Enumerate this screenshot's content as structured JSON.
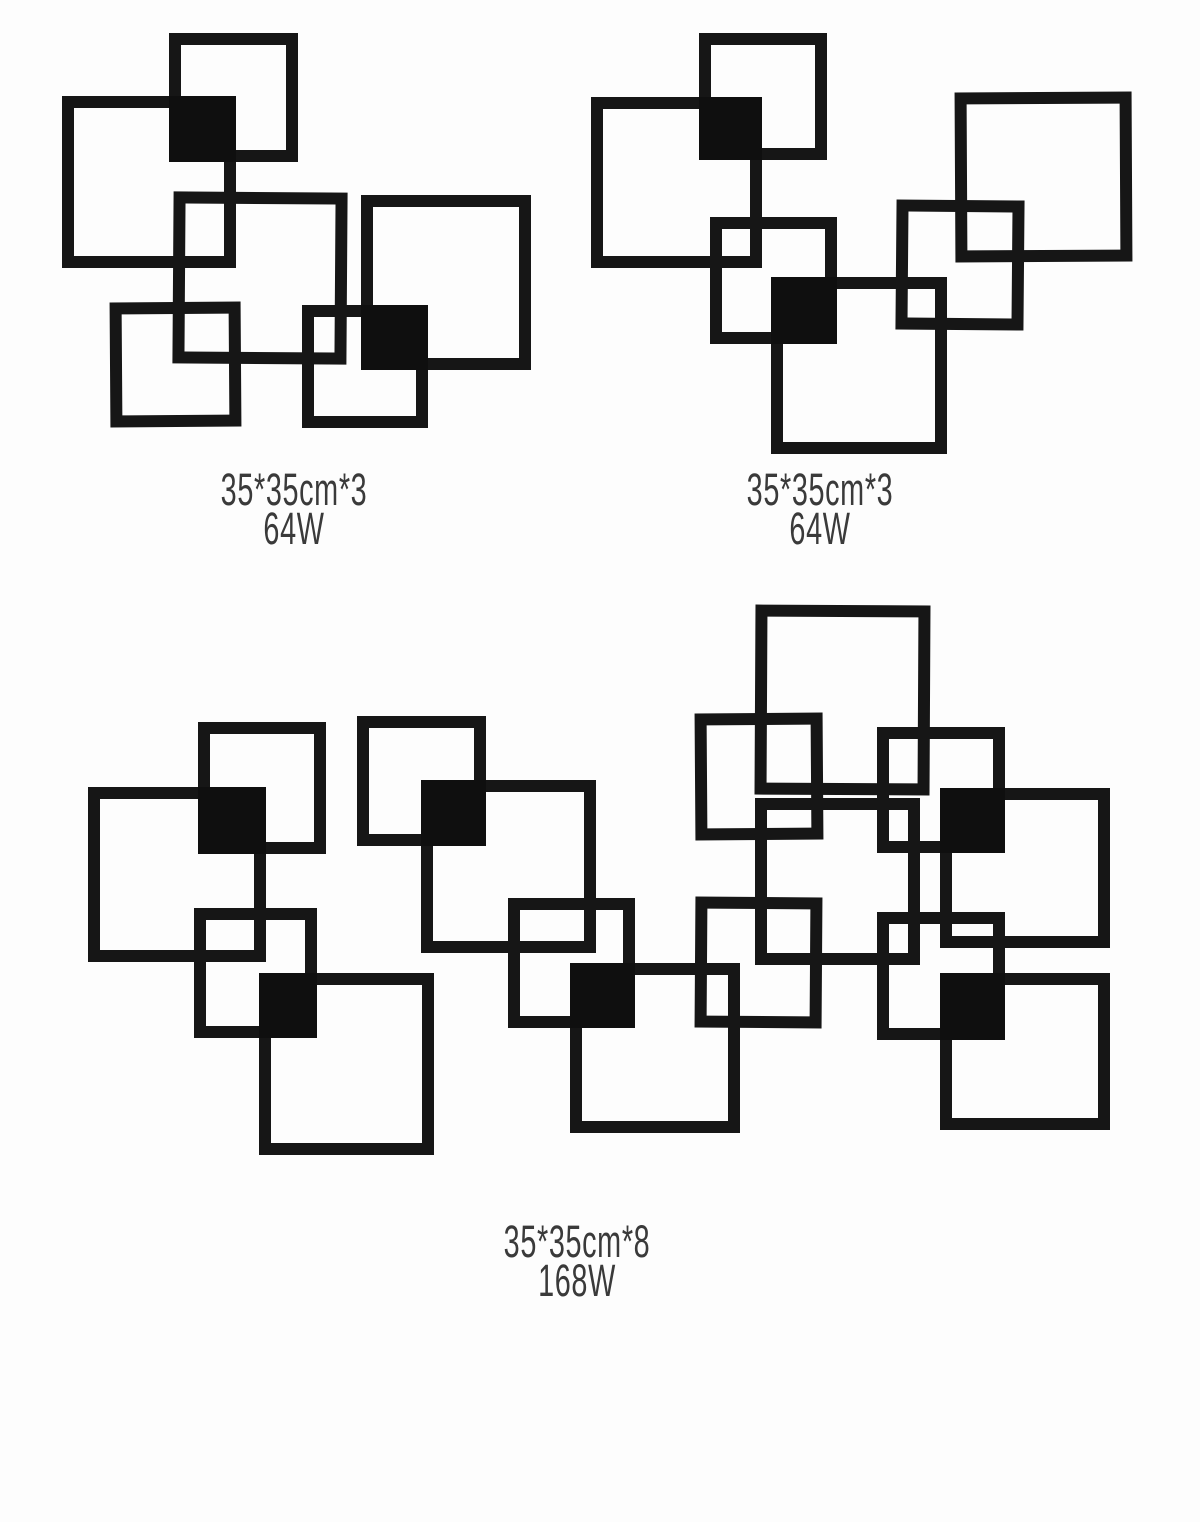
{
  "meta": {
    "canvas_width": 1200,
    "canvas_height": 1522,
    "background": "#fdfdfd"
  },
  "colors": {
    "frame": "#161616",
    "module": "#0f0f0f",
    "label_text": "#3a3a3a"
  },
  "stroke_width": 12,
  "arrangements": [
    {
      "name": "three-panel-left",
      "label": {
        "line1": "35*35cm*3",
        "line2": "64W",
        "cx": 294,
        "top": 470
      },
      "frames": [
        [
          169,
          33,
          129,
          129,
          0
        ],
        [
          62,
          96,
          174,
          172,
          0
        ],
        [
          173,
          192,
          174,
          172,
          0.4
        ],
        [
          361,
          195,
          170,
          175,
          0
        ],
        [
          110,
          302,
          131,
          125,
          -0.4
        ],
        [
          302,
          305,
          126,
          123,
          0
        ]
      ],
      "modules": [
        [
          169,
          96,
          67,
          66
        ],
        [
          361,
          305,
          67,
          65
        ]
      ]
    },
    {
      "name": "three-panel-right",
      "label": {
        "line1": "35*35cm*3",
        "line2": "64W",
        "cx": 820,
        "top": 470
      },
      "frames": [
        [
          699,
          33,
          128,
          127,
          0
        ],
        [
          591,
          97,
          171,
          171,
          0
        ],
        [
          710,
          217,
          127,
          127,
          0
        ],
        [
          771,
          277,
          176,
          177,
          0
        ],
        [
          896,
          200,
          128,
          130,
          0.5
        ],
        [
          955,
          92,
          177,
          170,
          -0.3
        ]
      ],
      "modules": [
        [
          699,
          97,
          63,
          63
        ],
        [
          771,
          277,
          66,
          67
        ]
      ]
    },
    {
      "name": "eight-panel",
      "label": {
        "line1": "35*35cm*8",
        "line2": "168W",
        "cx": 577,
        "top": 1222
      },
      "frames": [
        [
          198,
          722,
          128,
          132,
          0
        ],
        [
          88,
          787,
          178,
          175,
          0
        ],
        [
          194,
          908,
          123,
          130,
          0
        ],
        [
          259,
          973,
          175,
          182,
          0
        ],
        [
          357,
          716,
          129,
          130,
          0
        ],
        [
          421,
          780,
          175,
          173,
          0
        ],
        [
          695,
          713,
          128,
          127,
          -0.4
        ],
        [
          755,
          605,
          175,
          190,
          0.3
        ],
        [
          755,
          798,
          165,
          167,
          0
        ],
        [
          877,
          727,
          128,
          126,
          0
        ],
        [
          940,
          788,
          170,
          160,
          0
        ],
        [
          508,
          898,
          127,
          130,
          0
        ],
        [
          570,
          963,
          170,
          170,
          0
        ],
        [
          695,
          897,
          127,
          131,
          0.4
        ],
        [
          877,
          912,
          128,
          128,
          0
        ],
        [
          940,
          973,
          170,
          157,
          0
        ]
      ],
      "modules": [
        [
          198,
          787,
          68,
          67
        ],
        [
          259,
          973,
          58,
          65
        ],
        [
          421,
          780,
          65,
          66
        ],
        [
          940,
          788,
          65,
          65
        ],
        [
          570,
          963,
          65,
          65
        ],
        [
          940,
          973,
          65,
          67
        ]
      ]
    }
  ]
}
